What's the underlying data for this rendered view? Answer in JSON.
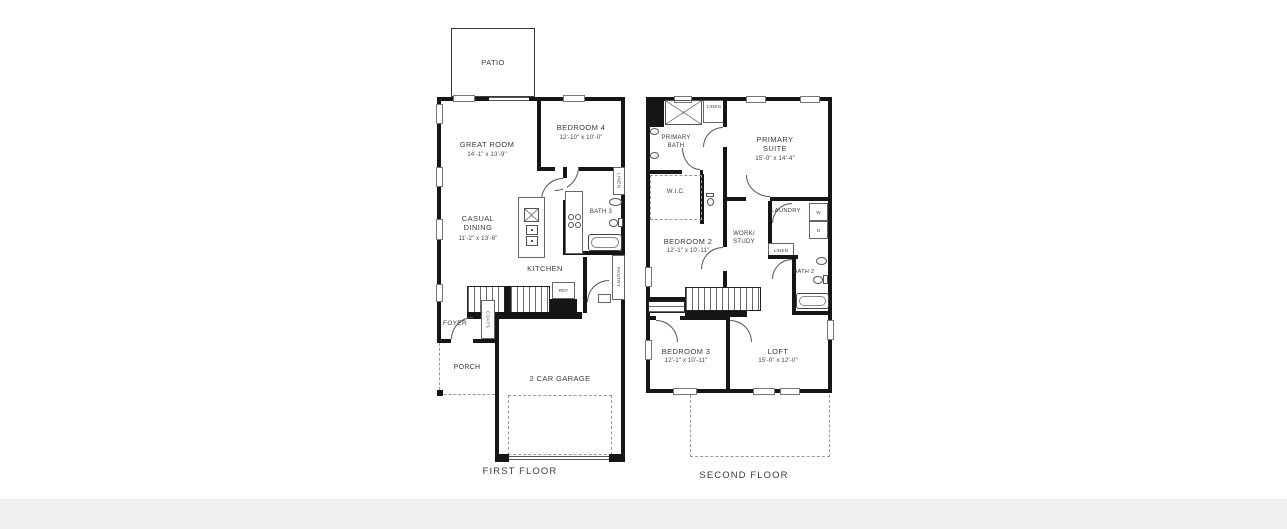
{
  "colors": {
    "wall": "#161616",
    "line": "#666666",
    "text": "#3b3b3b",
    "background": "#ffffff",
    "bottom_band": "#f0f0f0"
  },
  "ff": {
    "title": "FIRST FLOOR",
    "patio": "PATIO",
    "great_room": {
      "name": "GREAT ROOM",
      "dims": "14'-1\" x 13'-9\""
    },
    "bedroom4": {
      "name": "BEDROOM 4",
      "dims": "12'-10\" x 10'-0\""
    },
    "casual_dining": {
      "name": "CASUAL DINING",
      "dims": "11'-2\" x 13'-6\""
    },
    "bath3": "BATH 3",
    "kitchen": "KITCHEN",
    "ref": "REF",
    "linen": "LINEN",
    "pantry": "PANTRY",
    "coats": "COATS",
    "foyer": "FOYER",
    "porch": "PORCH",
    "garage": "2 CAR GARAGE"
  },
  "sf": {
    "title": "SECOND FLOOR",
    "primary_bath": "PRIMARY BATH",
    "linen_top": "LINEN",
    "primary_suite": {
      "name": "PRIMARY SUITE",
      "dims": "15'-0\" x 14'-4\""
    },
    "wic": "W.I.C.",
    "bedroom2": {
      "name": "BEDROOM 2",
      "dims": "12'-1\" x 10'-11\""
    },
    "work_study": "WORK/ STUDY",
    "laundry": "LAUNDRY",
    "washer": "W",
    "dryer": "D",
    "linen_mid": "LINEN",
    "bath2": "BATH 2",
    "bedroom3": {
      "name": "BEDROOM 3",
      "dims": "12'-1\" x 10'-11\""
    },
    "loft": {
      "name": "LOFT",
      "dims": "15'-0\" x 12'-0\""
    }
  }
}
